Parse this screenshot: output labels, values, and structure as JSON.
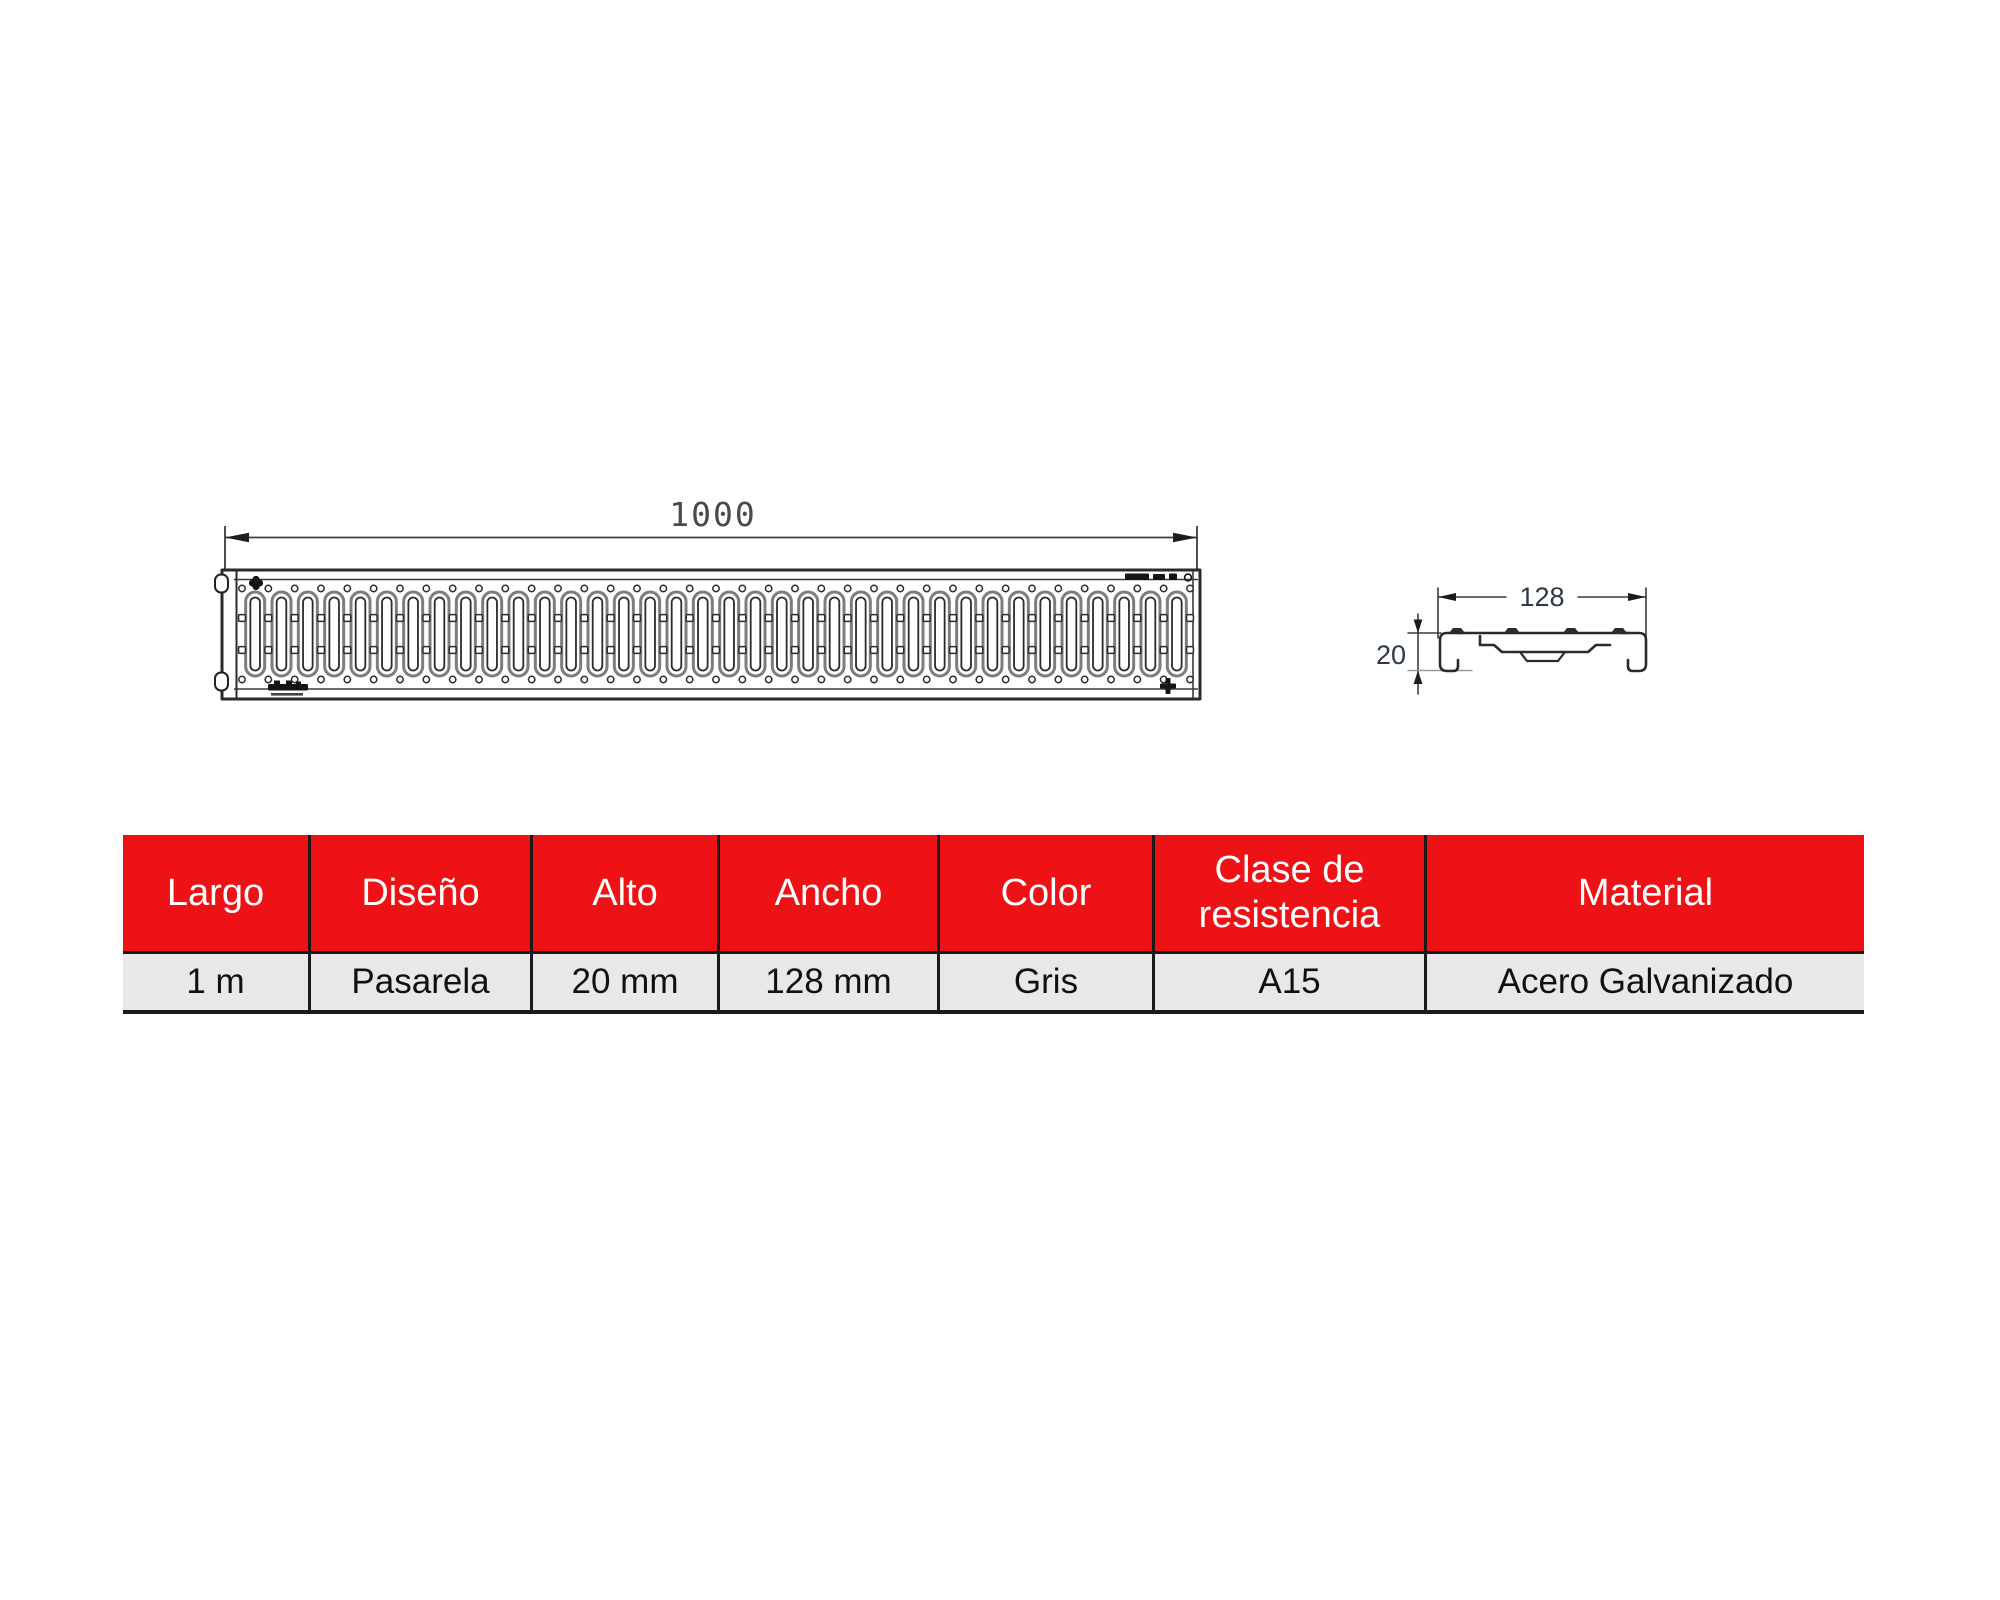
{
  "drawing": {
    "line_color": "#2b2b2b",
    "top_view": {
      "length_dimension_label": "1000",
      "slot_count": 36
    },
    "section_view": {
      "width_dimension_label": "128",
      "height_dimension_label": "20"
    }
  },
  "spec_table": {
    "columns": [
      {
        "id": "largo",
        "header": "Largo",
        "value": "1 m"
      },
      {
        "id": "diseno",
        "header": "Diseño",
        "value": "Pasarela"
      },
      {
        "id": "alto",
        "header": "Alto",
        "value": "20 mm"
      },
      {
        "id": "ancho",
        "header": "Ancho",
        "value": "128 mm"
      },
      {
        "id": "color",
        "header": "Color",
        "value": "Gris"
      },
      {
        "id": "clase",
        "header": "Clase de resistencia",
        "value": "A15"
      },
      {
        "id": "material",
        "header": "Material",
        "value": "Acero Galvanizado"
      }
    ],
    "colors": {
      "header_bg": "#ee1116",
      "header_text": "#ffffff",
      "row_bg": "#e8e8e8",
      "row_text": "#101010",
      "grid_line": "#1a1a1a"
    }
  }
}
